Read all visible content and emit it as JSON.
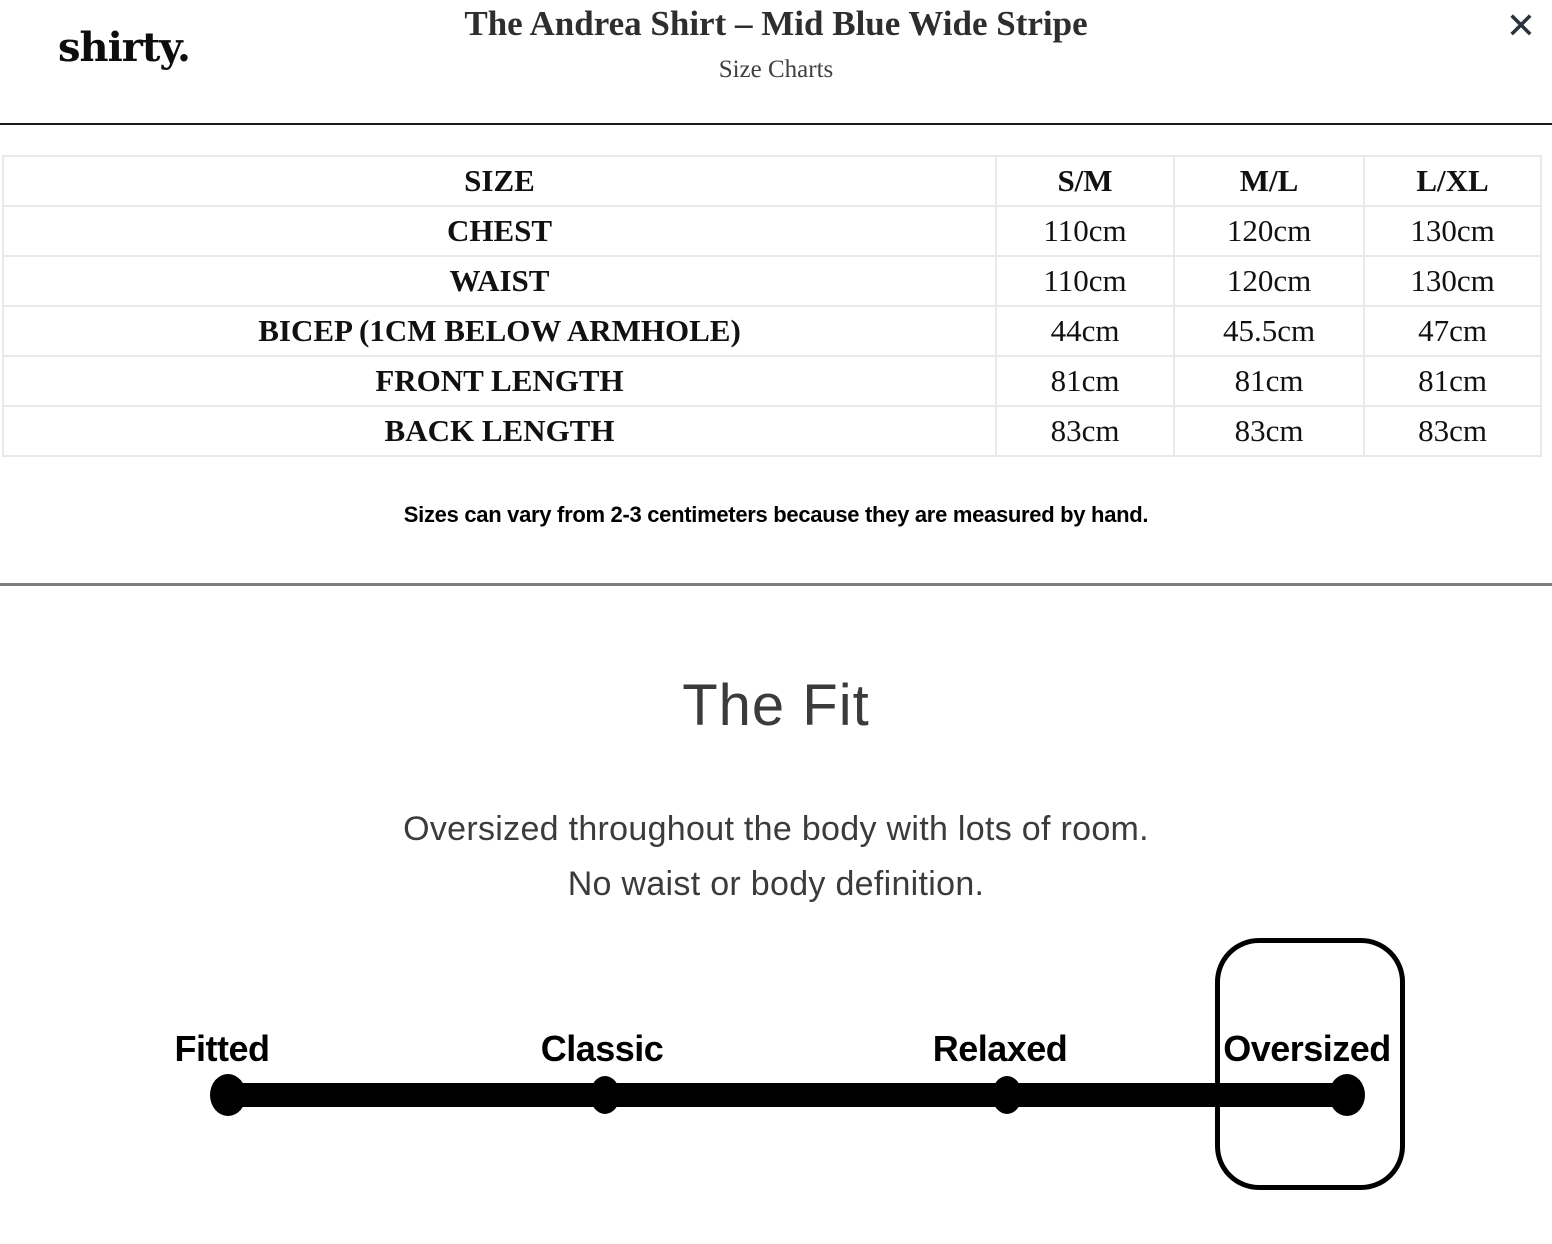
{
  "header": {
    "logo": "shirty.",
    "title": "The Andrea Shirt – Mid Blue Wide Stripe",
    "subtitle": "Size Charts",
    "close_icon": "✕"
  },
  "size_chart": {
    "columns": [
      "SIZE",
      "S/M",
      "M/L",
      "L/XL"
    ],
    "rows": [
      {
        "label": "CHEST",
        "values": [
          "110cm",
          "120cm",
          "130cm"
        ]
      },
      {
        "label": "WAIST",
        "values": [
          "110cm",
          "120cm",
          "130cm"
        ]
      },
      {
        "label": "BICEP (1CM BELOW ARMHOLE)",
        "values": [
          "44cm",
          "45.5cm",
          "47cm"
        ]
      },
      {
        "label": "FRONT LENGTH",
        "values": [
          "81cm",
          "81cm",
          "81cm"
        ]
      },
      {
        "label": "BACK LENGTH",
        "values": [
          "83cm",
          "83cm",
          "83cm"
        ]
      }
    ],
    "note": "Sizes can vary from 2-3 centimeters because they are measured by hand."
  },
  "fit": {
    "heading": "The Fit",
    "description_line1": "Oversized throughout the body with lots of room.",
    "description_line2": "No waist or body definition.",
    "scale": {
      "labels": [
        "Fitted",
        "Classic",
        "Relaxed",
        "Oversized"
      ],
      "selected": "Oversized"
    }
  },
  "colors": {
    "text_dark": "#1b1b1b",
    "divider_dark": "#1b1b1b",
    "divider_gray": "#7d7d7d",
    "table_border": "#e9e9e9",
    "scale_black": "#000000",
    "close_icon": "#2b333d"
  }
}
